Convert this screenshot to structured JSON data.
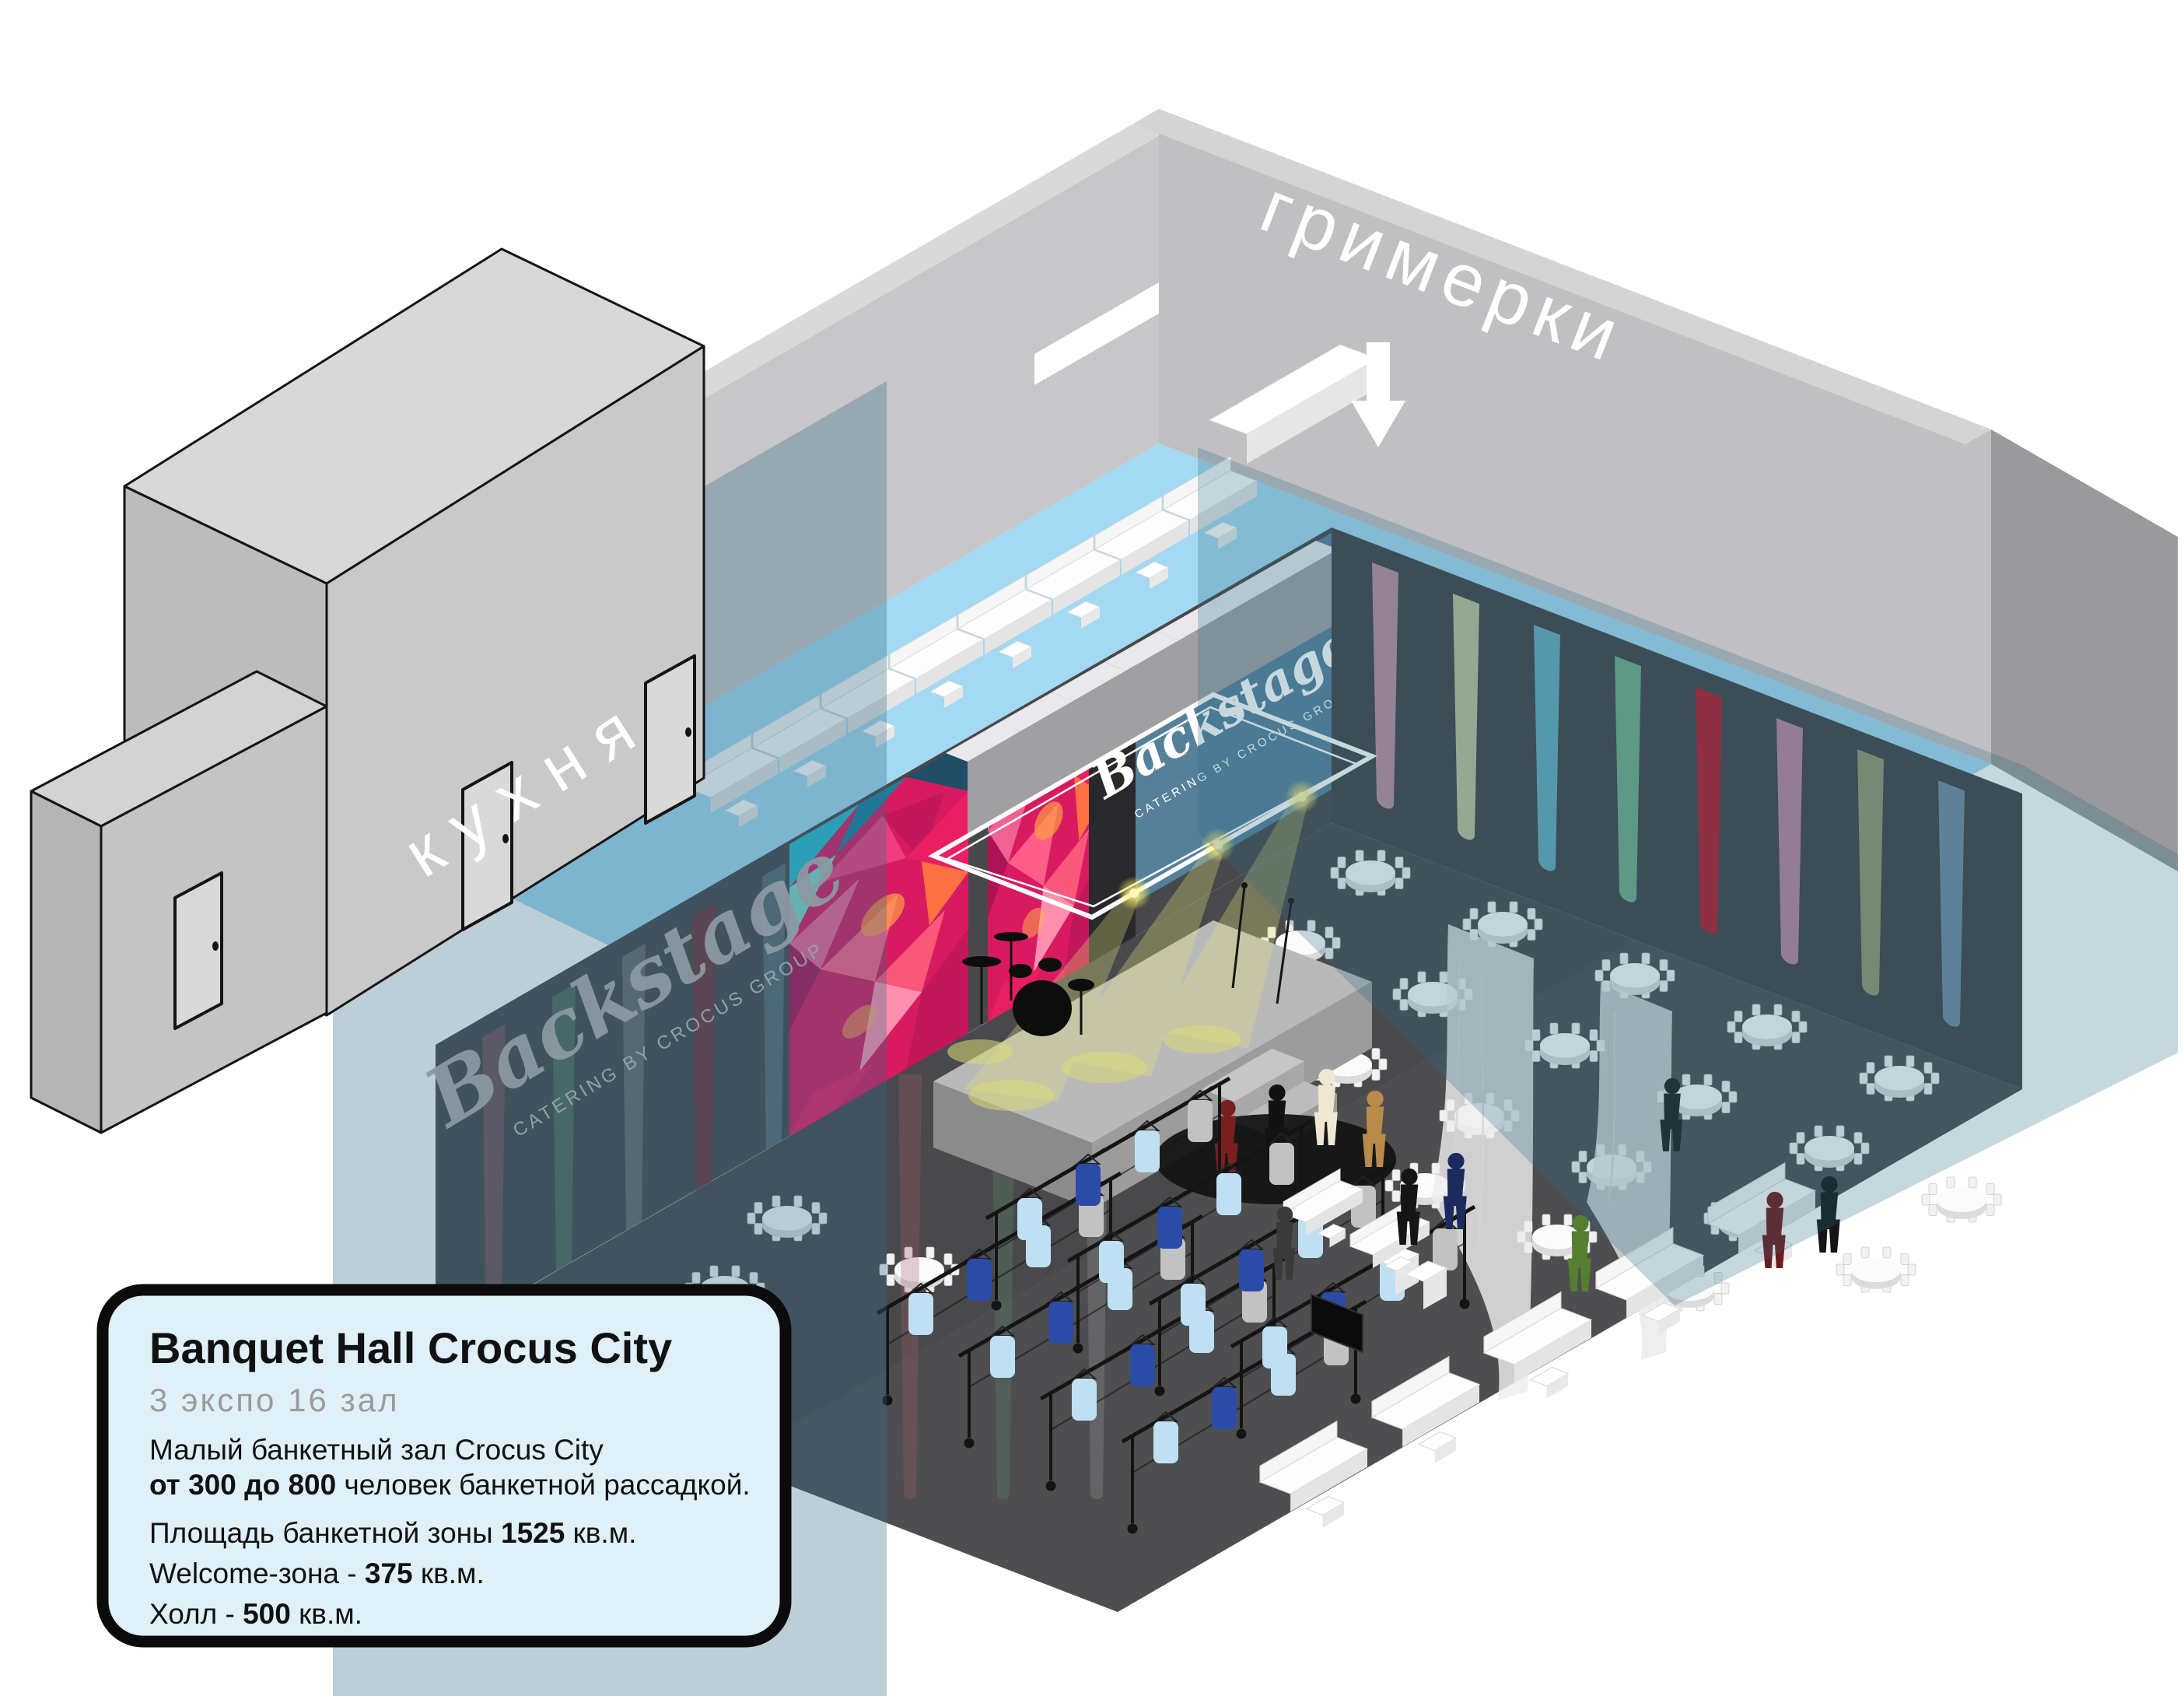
{
  "labels": {
    "dressing_rooms": "гримерки",
    "kitchen": "кухня"
  },
  "backstage": {
    "name": "Backstage",
    "caption": "CATERING BY CROCUS GROUP"
  },
  "info": {
    "title": "Banquet Hall Crocus City",
    "subtitle": "3 экспо 16 зал",
    "line1a": "Малый банкетный зал Crocus City",
    "line1b_bold": "от 300 до 800",
    "line1b_rest": " человек банкетной рассадкой.",
    "line2_pre": "Площадь банкетной зоны ",
    "line2_bold": "1525",
    "line2_post": " кв.м.",
    "line3_pre": "Welcome-зона - ",
    "line3_bold": "375",
    "line3_post": " кв.м.",
    "line4_pre": "Холл - ",
    "line4_bold": "500",
    "line4_post": " кв.м."
  },
  "colors": {
    "wall_gray": "#c7c7c9",
    "wall_gray2": "#c0c0c2",
    "hall_dark": "#48484b",
    "hall_dark2": "#434346",
    "floor_dark": "#4e4e51",
    "corridor_blue": "#a3d9f2",
    "glass_teal": "#2e6a86",
    "panel_teal": "#56809a",
    "infobox_bg": "#dff0f8",
    "accent_pink": "#e91e63",
    "beams": [
      "#d9a0b0",
      "#ddddb0",
      "#6fc3d6",
      "#7cc497",
      "#cf1125",
      "#d795ad",
      "#a8a878",
      "#7a9eb5"
    ],
    "beams_muted": [
      "#9a5a64",
      "#5a8a6a",
      "#8a8a8a",
      "#9a232e",
      "#6a8a9a"
    ],
    "beams_cloak": [
      "#a05a66",
      "#5a8a6a",
      "#9a9a9a"
    ]
  }
}
